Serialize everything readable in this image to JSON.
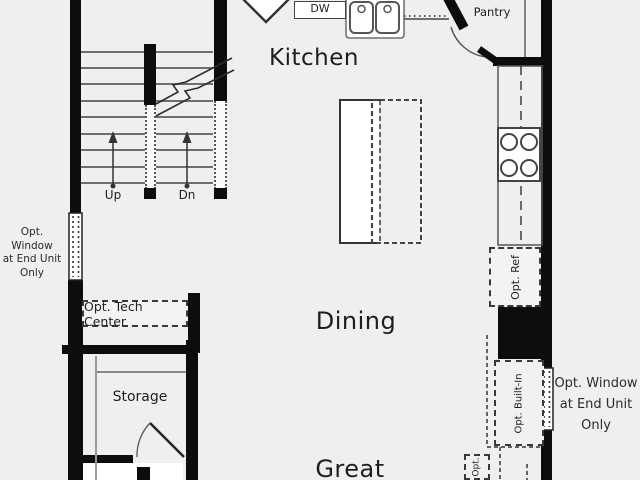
{
  "plan_type": "floorplan",
  "rooms": {
    "kitchen": "Kitchen",
    "dining": "Dining",
    "great": "Great",
    "pantry": "Pantry",
    "storage": "Storage"
  },
  "stairs": {
    "up": "Up",
    "down": "Dn"
  },
  "appliances": {
    "dishwasher": "DW"
  },
  "options": {
    "tech_center": "Opt. Tech Center",
    "refrigerator": "Opt. Ref",
    "built_in": "Opt. Built-In",
    "partial": "Opt.",
    "window_left": {
      "l1": "Opt. Window",
      "l2": "at End Unit",
      "l3": "Only"
    },
    "window_right": {
      "l1": "Opt. Window",
      "l2": "at End Unit",
      "l3": "Only"
    }
  },
  "colors": {
    "background": "#efefef",
    "wall": "#0d0d0d",
    "line": "#555555",
    "text": "#222222"
  }
}
